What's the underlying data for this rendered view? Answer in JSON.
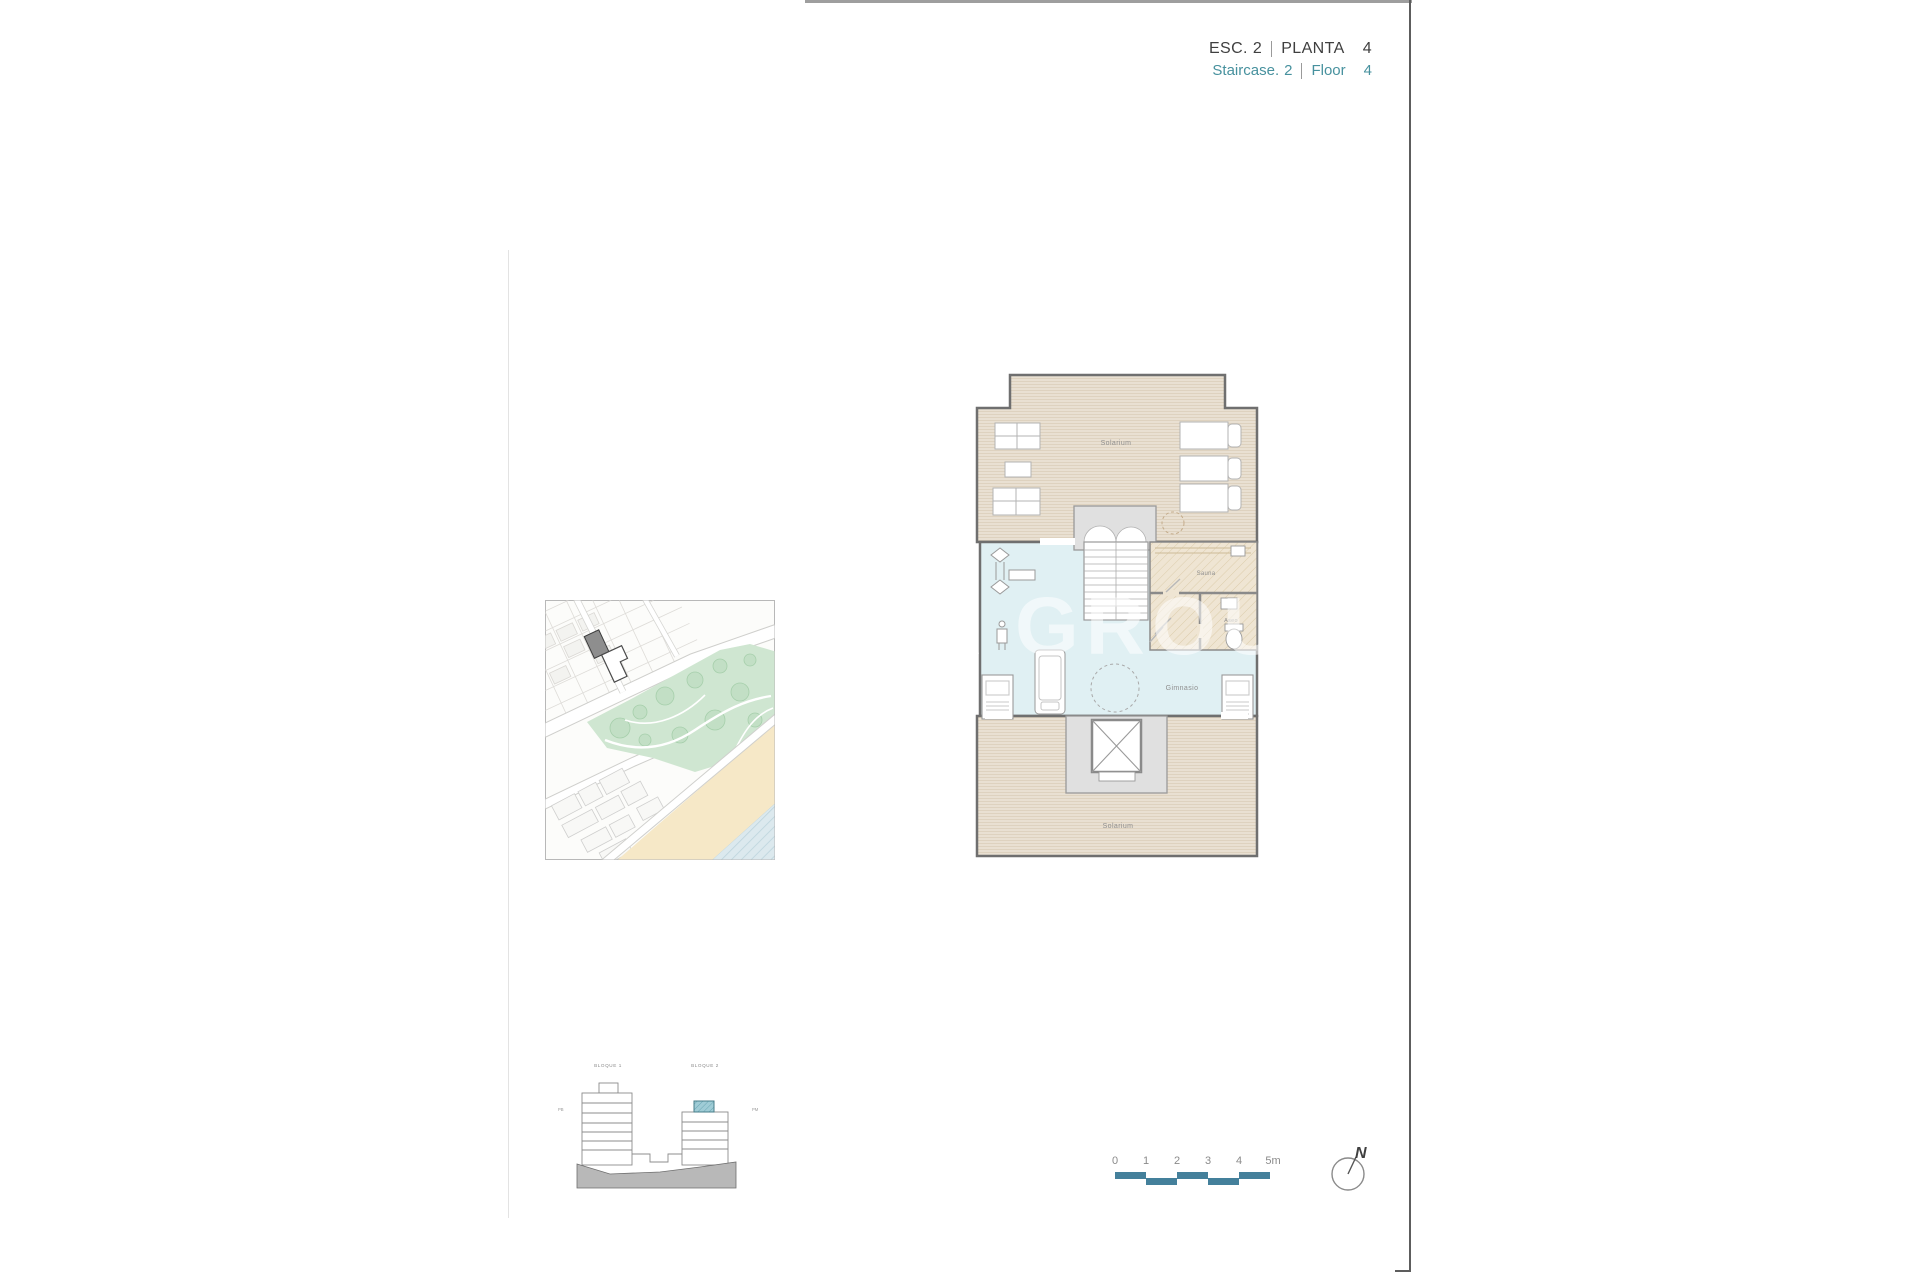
{
  "header": {
    "esc_label": "ESC.",
    "esc_num": "2",
    "planta_label": "PLANTA",
    "planta_num": "4",
    "staircase_label": "Staircase.",
    "staircase_num": "2",
    "floor_label": "Floor",
    "floor_num": "4",
    "accent_color": "#47919e"
  },
  "floor_plan": {
    "solarium_top_label": "Solarium",
    "solarium_bottom_label": "Solarium",
    "gym_label": "Gimnasio",
    "sauna_label": "Sauna",
    "toilet_label": "Aseo"
  },
  "elevation": {
    "block1_label": "BLOQUE 1",
    "block2_label": "BLOQUE 2",
    "left_ref_label": "PB",
    "right_ref_label": "PM",
    "highlight_color": "#9fccd6"
  },
  "scale_bar": {
    "ticks": [
      "0",
      "1",
      "2",
      "3",
      "4",
      "5m"
    ],
    "bar_color": "#44809b"
  },
  "compass": {
    "north_label": "N"
  },
  "watermark": {
    "text": "A GROUP"
  },
  "colors": {
    "solarium_fill": "#e9e0d2",
    "gym_fill": "#e0f0f3",
    "wall": "#6f6f6f",
    "park_green": "#cfe6d1",
    "beach_sand": "#f6e8c7",
    "sea_blue": "#dce9ee",
    "ground_gray": "#b8b8b8"
  }
}
